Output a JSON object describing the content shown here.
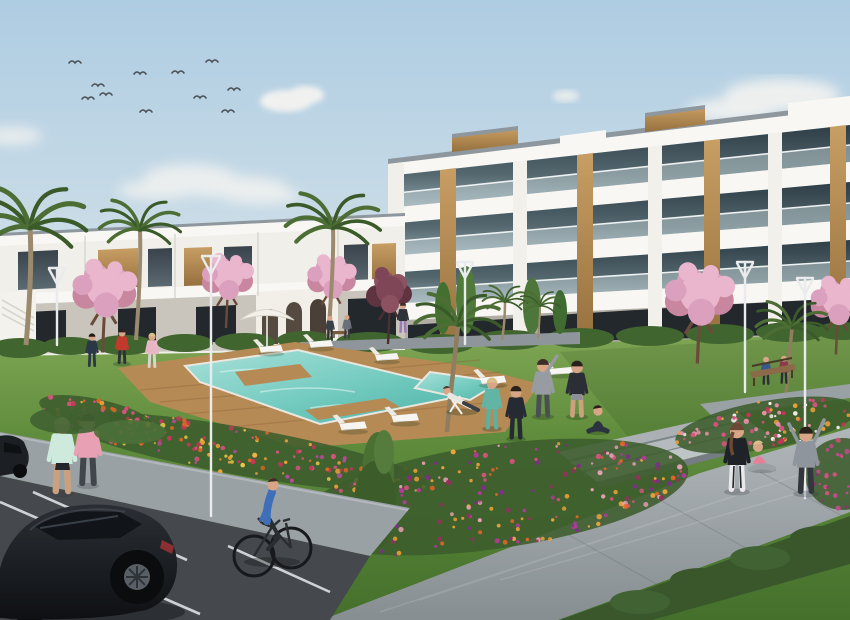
{
  "meta": {
    "title": "Residential complex exterior render",
    "description": "3D architectural rendering of a modern white apartment complex with communal lawn, turquoise swimming pool with wooden deck, palm trees, pink blossom trees, flower beds, residents exercising and relaxing, a cyclist, joggers and a parking area with a black hatchback under a light blue sky with a flock of birds"
  },
  "scene": {
    "setting": "sunny Mediterranean residential development, daytime",
    "palette": {
      "skyTop": "#aecce2",
      "skyBottom": "#d8e5eb",
      "cloud": "#f7f5f1",
      "wallWhite": "#f1efe9",
      "slab": "#f8f7f3",
      "roofCap": "#8d979d",
      "glassDark": "#32414a",
      "glassLight": "#74ototype",
      "wood": "#c79e63",
      "woodDark": "#9d7642",
      "lawnLight": "#82a955",
      "lawnDark": "#47742e",
      "hedge": "#41652f",
      "palmGreen": "#4c6e35",
      "blossomPink": "#e4a7c2",
      "maroonTree": "#7e4656",
      "poolLight": "#a8e0d8",
      "poolDeep": "#52b5a9",
      "deckWood": "#b68a55",
      "asphalt": "#45494e",
      "sidewalk": "#9aa1a5",
      "pathLight": "#a9b0b4",
      "carBlack": "#1b1e22",
      "skin": "#d8a686",
      "lampWhite": "#e9ebec",
      "accentRed": "#c13a2c",
      "accentTeal": "#62b4a4",
      "accentPink": "#e8889c",
      "accentBlue": "#3f6fb8"
    },
    "sky": {
      "birds_count": 11,
      "birds": [
        [
          75,
          63
        ],
        [
          88,
          99
        ],
        [
          98,
          86
        ],
        [
          106,
          95
        ],
        [
          140,
          74
        ],
        [
          146,
          112
        ],
        [
          178,
          73
        ],
        [
          200,
          98
        ],
        [
          212,
          62
        ],
        [
          234,
          90
        ],
        [
          228,
          112
        ]
      ],
      "clouds": "soft cumulus left-centre horizon, puffs upper-left and right edge"
    },
    "buildings": [
      {
        "name": "right-apartment-block",
        "storeys": 4,
        "style": "white modern slab balconies, dark glazing, timber accent piers, rooftop timber boxes"
      },
      {
        "name": "left-townhouse-row",
        "storeys": 2,
        "style": "white terraced row, walnut panels, arched ground-floor section, external stair"
      }
    ],
    "amenities": {
      "pool": "turquoise irregular pool with hardwood deck surround and deck fingers",
      "sun_loungers": 7,
      "parasol": 1,
      "benches": 2,
      "street_lamps": 5,
      "paths": "wide light-concrete promenade with three broad steps, parking lane with white stall markings"
    },
    "vegetation": {
      "palm_trees": 7,
      "blossom_trees": 5,
      "maroon_tree": 1,
      "flower_colors": [
        "orange",
        "yellow",
        "pink",
        "magenta",
        "purple",
        "red",
        "white"
      ]
    },
    "flower_beds": [
      {
        "name": "left-strip",
        "cx": 245,
        "cy": 452,
        "rx": 185,
        "ry": 24,
        "rot": 10,
        "count": 150,
        "colors": [
          "#e06428",
          "#eda23b",
          "#d8527e",
          "#c4375a",
          "#e8c84a",
          "#b84a9a"
        ]
      },
      {
        "name": "poolside",
        "cx": 96,
        "cy": 414,
        "rx": 58,
        "ry": 15,
        "rot": 12,
        "count": 50,
        "colors": [
          "#e06428",
          "#d8527e",
          "#eda23b",
          "#c4375a"
        ]
      },
      {
        "name": "center",
        "cx": 492,
        "cy": 497,
        "rx": 198,
        "ry": 52,
        "rot": -8,
        "count": 220,
        "colors": [
          "#b13a9a",
          "#7e2d8a",
          "#d8527e",
          "#e06428",
          "#93305e",
          "#e8a0b4",
          "#eda23b"
        ]
      },
      {
        "name": "right-upper",
        "cx": 766,
        "cy": 425,
        "rx": 92,
        "ry": 24,
        "rot": -10,
        "count": 95,
        "colors": [
          "#d8527e",
          "#c4375a",
          "#e88fa8",
          "#eda23b",
          "#f2f0ea"
        ]
      },
      {
        "name": "right-edge",
        "cx": 843,
        "cy": 474,
        "rx": 38,
        "ry": 36,
        "rot": 0,
        "count": 45,
        "colors": [
          "#c44a90",
          "#8a2f72",
          "#d8527e"
        ]
      }
    ],
    "people": [
      {
        "who": "jogger-mint",
        "activity": "walking on sidewalk",
        "top": "#cdeadd"
      },
      {
        "who": "jogger-pink",
        "activity": "walking on sidewalk",
        "top": "#e8a0b4"
      },
      {
        "who": "man-red-shirt",
        "activity": "stretching by loungers",
        "top": "#c13a2c"
      },
      {
        "who": "person-navy",
        "activity": "standing on lawn",
        "top": "#2c3746"
      },
      {
        "who": "person-pink-white",
        "activity": "standing on lawn",
        "top": "#e8b6c4"
      },
      {
        "who": "man-deckchair",
        "activity": "reclining on deck chair",
        "top": "#e8e6e0"
      },
      {
        "who": "woman-teal",
        "activity": "exercising",
        "top": "#62b4a4"
      },
      {
        "who": "person-tracksuit",
        "activity": "exercising",
        "top": "#262b33"
      },
      {
        "who": "man-grey-stretch",
        "activity": "side stretch",
        "top": "#979ba2"
      },
      {
        "who": "man-black-top",
        "activity": "exercising",
        "top": "#2b2f35"
      },
      {
        "who": "woman-sitting",
        "activity": "seated cross-legged",
        "top": "#2c3340"
      },
      {
        "who": "woman-black-tank",
        "activity": "standing by steps",
        "top": "#1f2327"
      },
      {
        "who": "woman-pink-sitting",
        "activity": "sitting on steps",
        "top": "#e87f96"
      },
      {
        "who": "person-hoodie-v",
        "activity": "arms raised",
        "top": "#8f959c"
      },
      {
        "who": "bench-pair",
        "activity": "sitting on bench",
        "top": "#3a5a8c / #8c3a4a"
      },
      {
        "who": "cyclist-blue",
        "activity": "riding bicycle on road",
        "top": "#3f6fb8"
      },
      {
        "who": "distant-walkers",
        "activity": "walking near townhouses",
        "top": "#3a4048"
      }
    ],
    "vehicles": [
      {
        "name": "black-hatchback",
        "color": "#1b1e22",
        "position": "foreground parking"
      },
      {
        "name": "partial-parked-car",
        "color": "#1c2024",
        "position": "left edge"
      },
      {
        "name": "bicycle",
        "color": "#17191c",
        "position": "road"
      }
    ]
  }
}
